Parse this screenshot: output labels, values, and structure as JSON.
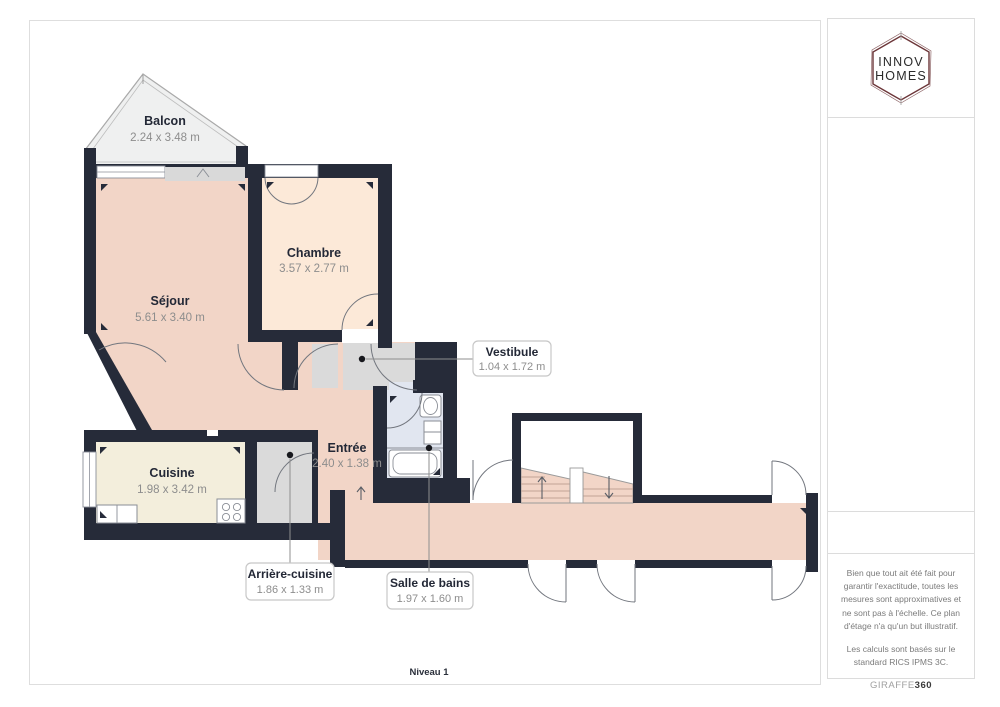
{
  "branding": {
    "logo_line1": "INNOV",
    "logo_line2": "HOMES"
  },
  "floor": {
    "level_label": "Niveau 1"
  },
  "rooms": [
    {
      "id": "balcon",
      "name": "Balcon",
      "dims": "2.24 x 3.48 m"
    },
    {
      "id": "sejour",
      "name": "Séjour",
      "dims": "5.61 x 3.40 m"
    },
    {
      "id": "chambre",
      "name": "Chambre",
      "dims": "3.57 x 2.77 m"
    },
    {
      "id": "cuisine",
      "name": "Cuisine",
      "dims": "1.98 x 3.42 m"
    },
    {
      "id": "entree",
      "name": "Entrée",
      "dims": "2.40 x 1.38 m"
    },
    {
      "id": "vestibule",
      "name": "Vestibule",
      "dims": "1.04 x 1.72 m"
    },
    {
      "id": "arriere_cuisine",
      "name": "Arrière-cuisine",
      "dims": "1.86 x 1.33 m"
    },
    {
      "id": "salle_de_bains",
      "name": "Salle de bains",
      "dims": "1.97 x 1.60 m"
    }
  ],
  "disclaimer": {
    "paragraph1": "Bien que tout ait été fait pour garantir l'exactitude, toutes les mesures sont approximatives et ne sont pas à l'échelle. Ce plan d'étage n'a qu'un but illustratif.",
    "paragraph2": "Les calculs sont basés sur le standard RICS IPMS 3C."
  },
  "footer_brand": {
    "light": "GIRAFFE",
    "bold": "360"
  },
  "colors": {
    "wall": "#262b39",
    "pink": "#f2d5c7",
    "peach": "#fce9d8",
    "cream": "#f3eedc",
    "bath": "#e1e6f0",
    "grayroom": "#dadada",
    "balcony": "#eff0f0",
    "accent": "#6b3538",
    "label": "#232836",
    "dims": "#8d8d8d"
  }
}
